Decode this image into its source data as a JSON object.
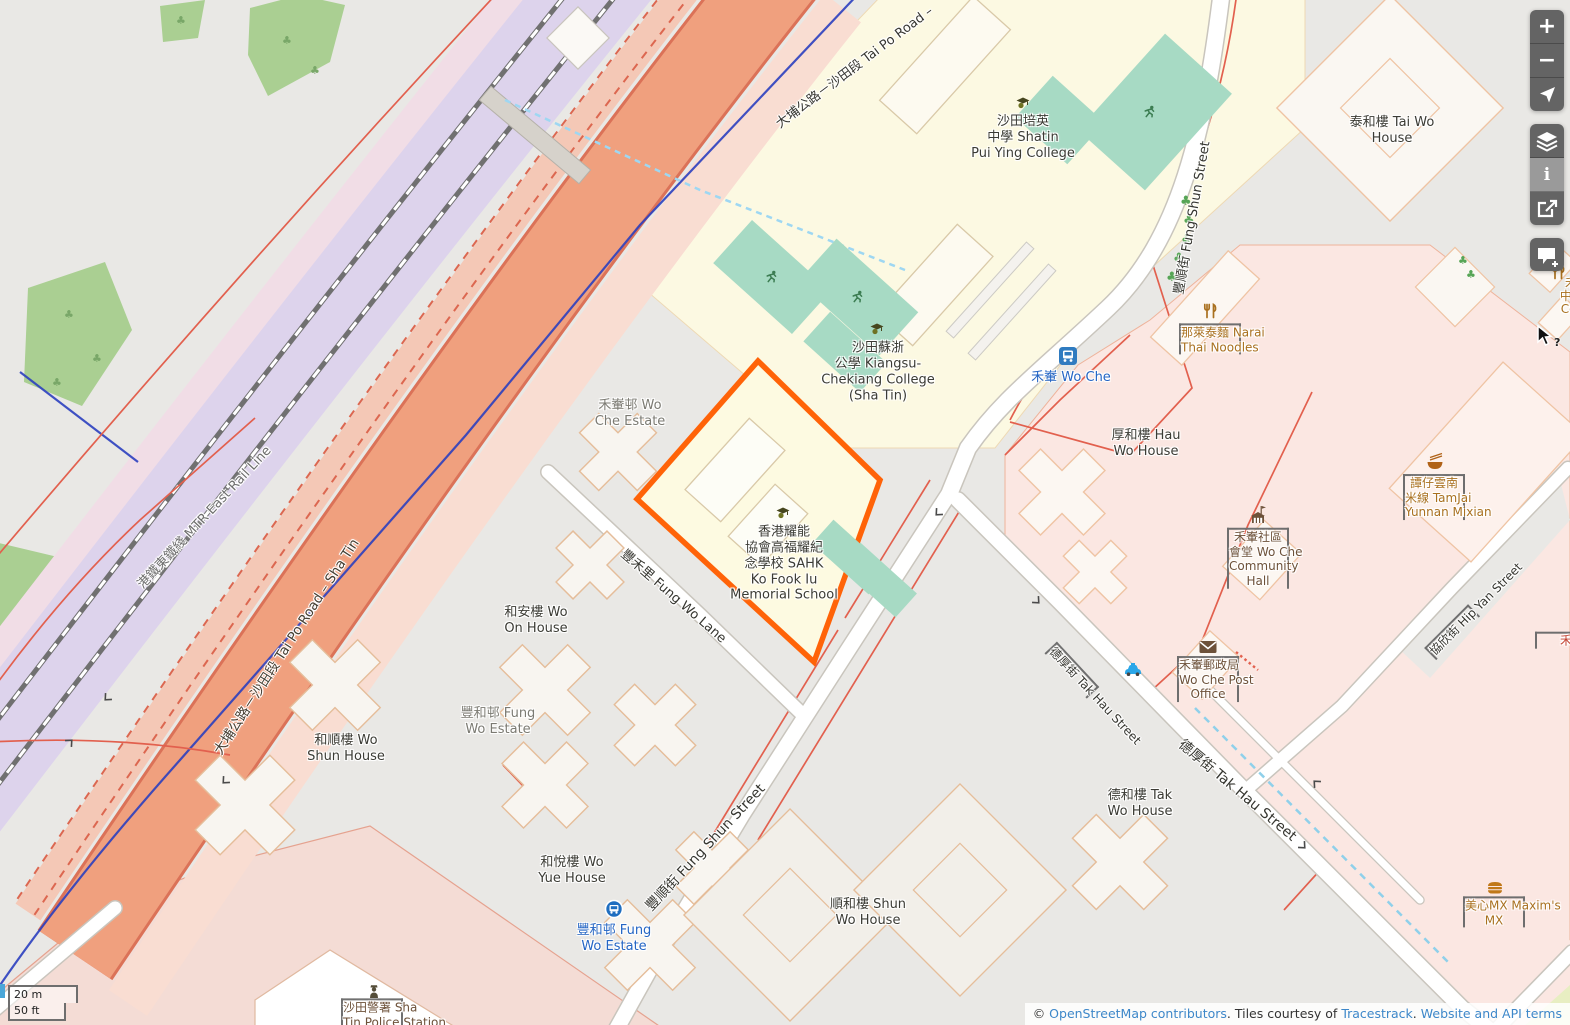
{
  "colors": {
    "highlight": "#ff6308",
    "link_blue": "#3d87c9",
    "transit_blue": "#2465c4",
    "poi_orange": "#a9701f",
    "poi_brown": "#6d5139",
    "pitch_teal": "#a7dac4",
    "road_trunk": "#f0a07e",
    "railway_band": "#ddd3ec"
  },
  "labels": {
    "tai_po_road_top": {
      "text": "大埔公路－沙田段 Tai Po Road –"
    },
    "mtr": {
      "text": "港鐵東鐵綫 MTR East Rail Line"
    },
    "tai_po_road": {
      "text": "大埔公路－沙田段 Tai Po Road – Sha Tin"
    },
    "pui_ying": {
      "lines": [
        "沙田培英",
        "中學 Shatin",
        "Pui Ying College"
      ]
    },
    "kiangsu": {
      "lines": [
        "沙田蘇浙",
        "公學 Kiangsu-",
        "Chekiang College",
        "(Sha Tin)"
      ]
    },
    "tai_wo_house": {
      "lines": [
        "泰和樓 Tai Wo",
        "House"
      ]
    },
    "fung_shun_street_n": {
      "text": "豐順街 Fung Shun Street"
    },
    "wo_che_station": {
      "text": "禾輋 Wo Che"
    },
    "narai": {
      "lines": [
        "那萊泰麵 Narai",
        "Thai Noodles"
      ]
    },
    "wo_che_estate": {
      "lines": [
        "禾輋邨 Wo",
        "Che Estate"
      ]
    },
    "hau_wo_house": {
      "lines": [
        "厚和樓 Hau",
        "Wo House"
      ]
    },
    "tamjai": {
      "lines": [
        "譚仔雲南",
        "米線 TamJai",
        "Yunnan Mixian"
      ]
    },
    "sahk": {
      "lines": [
        "香港耀能",
        "協會高福耀紀",
        "念學校 SAHK",
        "Ko Fook Iu",
        "Memorial School"
      ]
    },
    "community_hall": {
      "lines": [
        "禾輋社區",
        "會堂 Wo Che",
        "Community",
        "Hall"
      ]
    },
    "wo_on_house": {
      "lines": [
        "和安樓 Wo",
        "On House"
      ]
    },
    "fung_wo_lane": {
      "text": "豐禾里 Fung Wo Lane"
    },
    "post_office": {
      "lines": [
        "禾輋郵政局",
        "Wo Che Post",
        "Office"
      ]
    },
    "hip_yan_street": {
      "text": "協欣街 Hip Yan Street"
    },
    "wo_shun_house": {
      "lines": [
        "和順樓 Wo",
        "Shun House"
      ]
    },
    "fung_wo_estate": {
      "lines": [
        "豐和邨 Fung",
        "Wo Estate"
      ]
    },
    "tak_hau_street_small": {
      "text": "德厚街 Tak Hau Street"
    },
    "tak_wo_house": {
      "lines": [
        "德和樓 Tak",
        "Wo House"
      ]
    },
    "tak_hau_street_big": {
      "text": "德厚街 Tak Hau Street"
    },
    "wo_yue_house": {
      "lines": [
        "和悅樓 Wo",
        "Yue House"
      ]
    },
    "fung_shun_street_s": {
      "text": "豐順街 Fung Shun Street"
    },
    "fung_wo_stop": {
      "lines": [
        "豐和邨 Fung",
        "Wo Estate"
      ]
    },
    "shun_wo_house": {
      "lines": [
        "順和樓 Shun",
        "Wo House"
      ]
    },
    "maxims": {
      "lines": [
        "美心MX Maxim's",
        "MX"
      ]
    },
    "police": {
      "lines": [
        "沙田警署 Sha",
        "Tin Police Station"
      ]
    },
    "cooked_stall": {
      "lines": [
        "禾輋熟",
        "中心 Wo",
        "Cooked",
        "Stal"
      ]
    },
    "edge_partial": {
      "text": "禾"
    },
    "help_mark": {
      "text": "?"
    }
  },
  "controls": {
    "zoom_in": "+",
    "zoom_out": "−",
    "info_glyph": "i",
    "locate_icon": "locate-arrow",
    "layers_icon": "layers",
    "share_icon": "share",
    "add_note_icon": "add-note"
  },
  "scale": {
    "metric": "20 m",
    "imperial": "50 ft"
  },
  "attribution": {
    "prefix": "© ",
    "osm": "OpenStreetMap contributors",
    "mid1": ". Tiles courtesy of ",
    "tracestrack": "Tracestrack",
    "mid2": ". ",
    "terms": "Website and API terms"
  }
}
